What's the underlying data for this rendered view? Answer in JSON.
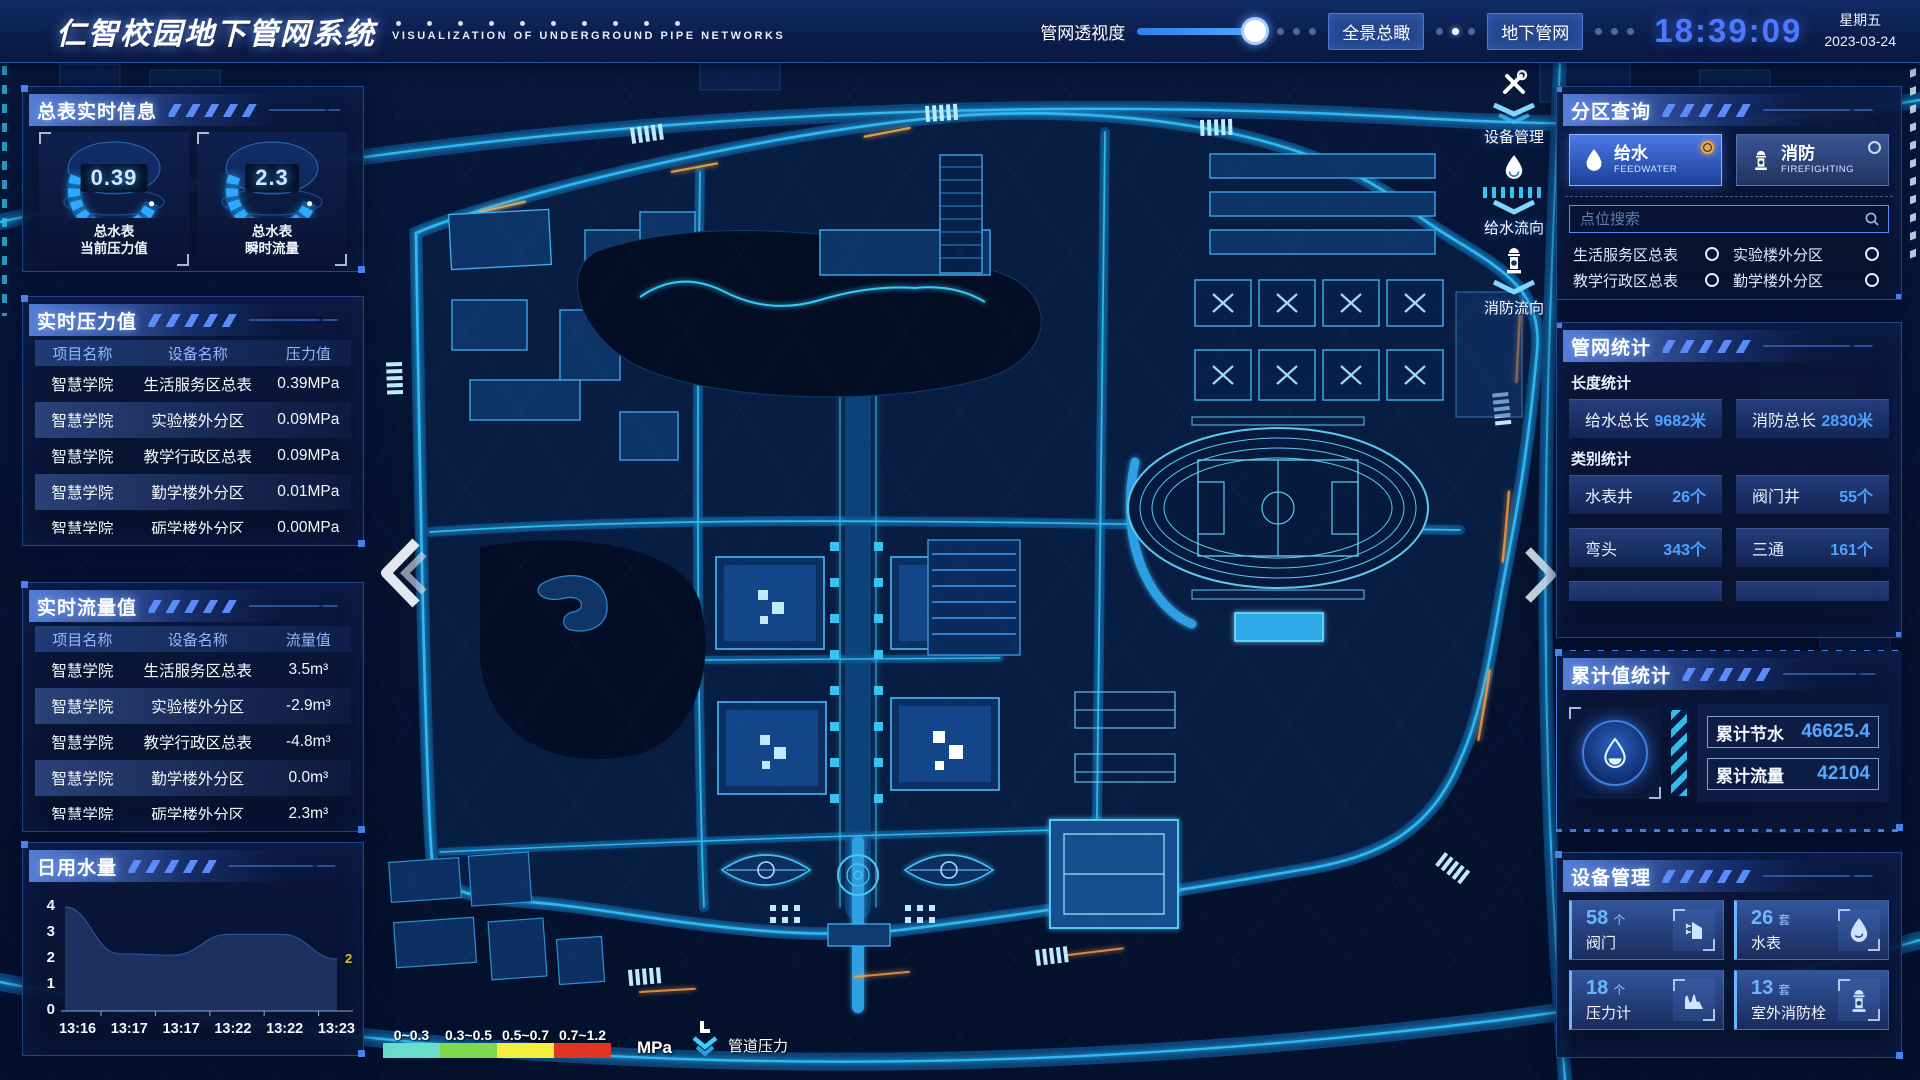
{
  "header": {
    "title": "仁智校园地下管网系统",
    "subtitle": "VISUALIZATION OF UNDERGROUND PIPE NETWORKS",
    "slider_label": "管网透视度",
    "btn_overview": "全景总瞰",
    "btn_underground": "地下管网",
    "time": "18:39:09",
    "weekday": "星期五",
    "date": "2023-03-24"
  },
  "left": {
    "meter_info": {
      "title": "总表实时信息",
      "gauges": [
        {
          "value": "0.39",
          "line1": "总水表",
          "line2": "当前压力值"
        },
        {
          "value": "2.3",
          "line1": "总水表",
          "line2": "瞬时流量"
        }
      ]
    },
    "pressure": {
      "title": "实时压力值",
      "headers": [
        "项目名称",
        "设备名称",
        "压力值"
      ],
      "rows": [
        [
          "智慧学院",
          "生活服务区总表",
          "0.39MPa"
        ],
        [
          "智慧学院",
          "实验楼外分区",
          "0.09MPa"
        ],
        [
          "智慧学院",
          "教学行政区总表",
          "0.09MPa"
        ],
        [
          "智慧学院",
          "勤学楼外分区",
          "0.01MPa"
        ],
        [
          "智慧学院",
          "砺学楼外分区",
          "0.00MPa"
        ]
      ]
    },
    "flow": {
      "title": "实时流量值",
      "headers": [
        "项目名称",
        "设备名称",
        "流量值"
      ],
      "rows": [
        [
          "智慧学院",
          "生活服务区总表",
          "3.5m³"
        ],
        [
          "智慧学院",
          "实验楼外分区",
          "-2.9m³"
        ],
        [
          "智慧学院",
          "教学行政区总表",
          "-4.8m³"
        ],
        [
          "智慧学院",
          "勤学楼外分区",
          "0.0m³"
        ],
        [
          "智慧学院",
          "砺学楼外分区",
          "2.3m³"
        ]
      ]
    },
    "daily_water": {
      "title": "日用水量",
      "chart_data": {
        "type": "area",
        "x": [
          "13:16",
          "13:17",
          "13:17",
          "13:22",
          "13:22",
          "13:23"
        ],
        "values": [
          4,
          2.2,
          2.15,
          2.95,
          2.95,
          2
        ],
        "yticks": [
          4,
          3,
          2,
          1,
          0
        ],
        "ylim": [
          0,
          4
        ],
        "end_label": "2",
        "end_label_color": "#e0b93a",
        "area_color": "#1d3160"
      }
    }
  },
  "right": {
    "zone_query": {
      "title": "分区查询",
      "tabs": [
        {
          "label": "给水",
          "sub": "FEEDWATER",
          "selected": true
        },
        {
          "label": "消防",
          "sub": "FIREFIGHTING",
          "selected": false
        }
      ],
      "search_placeholder": "点位搜索",
      "points": [
        "生活服务区总表",
        "实验楼外分区",
        "教学行政区总表",
        "勤学楼外分区",
        "砺学楼外分区",
        "宿舍区泵房"
      ]
    },
    "pipe_stats": {
      "title": "管网统计",
      "length_label": "长度统计",
      "length_stats": [
        {
          "label": "给水总长",
          "value": "9682米"
        },
        {
          "label": "消防总长",
          "value": "2830米"
        }
      ],
      "category_label": "类别统计",
      "category_stats": [
        {
          "label": "水表井",
          "value": "26个"
        },
        {
          "label": "阀门井",
          "value": "55个"
        },
        {
          "label": "弯头",
          "value": "343个"
        },
        {
          "label": "三通",
          "value": "161个"
        }
      ]
    },
    "cumulative": {
      "title": "累计值统计",
      "stats": [
        {
          "label": "累计节水",
          "value": "46625.4"
        },
        {
          "label": "累计流量",
          "value": "42104"
        }
      ]
    },
    "devices": {
      "title": "设备管理",
      "cards": [
        {
          "count": "58",
          "unit": "个",
          "label": "阀门",
          "icon": "valve-icon"
        },
        {
          "count": "26",
          "unit": "套",
          "label": "水表",
          "icon": "water-meter-icon"
        },
        {
          "count": "18",
          "unit": "个",
          "label": "压力计",
          "icon": "pressure-gauge-icon"
        },
        {
          "count": "13",
          "unit": "套",
          "label": "室外消防栓",
          "icon": "hydrant-icon"
        }
      ]
    }
  },
  "map": {
    "tools": [
      {
        "label": "设备管理",
        "icon": "wrench-icon"
      },
      {
        "label": "给水流向",
        "icon": "water-drop-icon"
      },
      {
        "label": "消防流向",
        "icon": "hydrant-icon"
      }
    ],
    "legend": {
      "ranges": [
        {
          "label": "0~0.3",
          "color": "#69dcca"
        },
        {
          "label": "0.3~0.5",
          "color": "#7ed94f"
        },
        {
          "label": "0.5~0.7",
          "color": "#f4ee3f"
        },
        {
          "label": "0.7~1.2",
          "color": "#e23423"
        }
      ],
      "unit": "MPa",
      "pressure_label": "管道压力"
    }
  },
  "colors": {
    "accent_cyan": "#35d0ff",
    "time_blue": "#4b79ff",
    "value_blue": "#4fa3ff",
    "selected_radio": "#f2a93b"
  }
}
